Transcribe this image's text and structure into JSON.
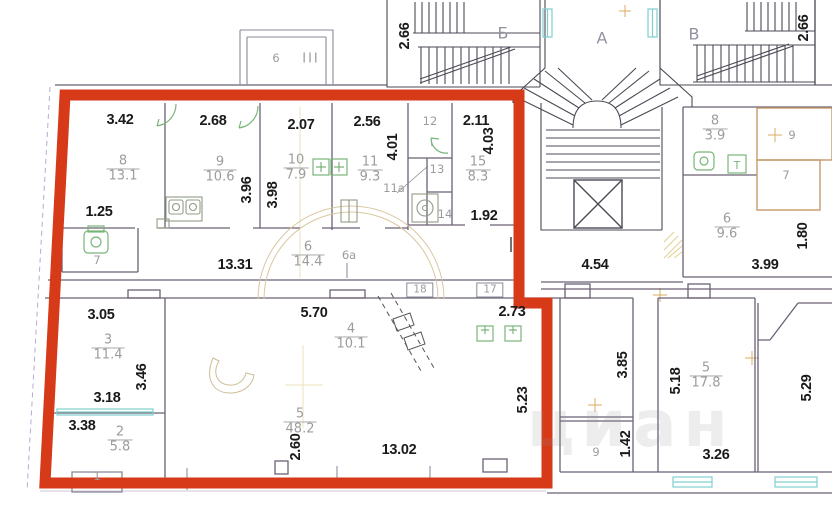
{
  "watermark": "циан",
  "colors": {
    "outline_red": "#d63a18",
    "wall": "#6b6075",
    "stair_line": "#4a4a55",
    "window_cyan": "#7fcfcf",
    "fixture_green": "#7ab57a",
    "tan_room": "#c49a6a",
    "guide_yellow": "#e8d79a",
    "dim_text": "#1a1a1a",
    "room_text": "#9c9c9c"
  },
  "stairs": {
    "left_label": "Б",
    "center_label": "А",
    "right_label": "В"
  },
  "balcony": {
    "number": "6",
    "hatch_mark": "III"
  },
  "rooms": {
    "r8": {
      "num": "8",
      "area": "13.1"
    },
    "r9": {
      "num": "9",
      "area": "10.6"
    },
    "r10": {
      "num": "10",
      "area": "7.9"
    },
    "r11": {
      "num": "11",
      "area": "9.3"
    },
    "r15": {
      "num": "15",
      "area": "8.3"
    },
    "r6": {
      "num": "6",
      "area": "14.4"
    },
    "r3": {
      "num": "3",
      "area": "11.4"
    },
    "r2": {
      "num": "2",
      "area": "5.8"
    },
    "r5": {
      "num": "5",
      "area": "48.2"
    },
    "r4": {
      "num": "4",
      "area": "10.1"
    },
    "n8": {
      "num": "8",
      "area": "3.9"
    },
    "n6": {
      "num": "6",
      "area": "9.6"
    },
    "n5": {
      "num": "5",
      "area": "17.8"
    }
  },
  "labels": {
    "room12": "12",
    "room13": "13",
    "room14": "14",
    "room11a": "11а",
    "room6a": "6а",
    "wc7": "7",
    "neighbor9": "9",
    "neighbor7": "7",
    "small9": "9",
    "balc1": "1",
    "box17": "17",
    "box18": "18",
    "t_fixture": "Т"
  },
  "dims": {
    "d3_42": "3.42",
    "d2_68": "2.68",
    "d2_07": "2.07",
    "d2_56": "2.56",
    "d2_11": "2.11",
    "d4_01": "4.01",
    "d4_03": "4.03",
    "d3_96": "3.96",
    "d3_98": "3.98",
    "d1_25": "1.25",
    "d13_31": "13.31",
    "d1_92": "1.92",
    "d3_05": "3.05",
    "d3_46": "3.46",
    "d3_18": "3.18",
    "d3_38": "3.38",
    "d5_70": "5.70",
    "d2_73": "2.73",
    "d2_60": "2.60",
    "d13_02": "13.02",
    "d5_23": "5.23",
    "d4_54": "4.54",
    "d3_99": "3.99",
    "d1_80": "1.80",
    "d2_66_left": "2.66",
    "d2_66_right": "2.66",
    "d3_85": "3.85",
    "d1_42": "1.42",
    "d5_18": "5.18",
    "d3_26": "3.26",
    "d5_29": "5.29"
  }
}
